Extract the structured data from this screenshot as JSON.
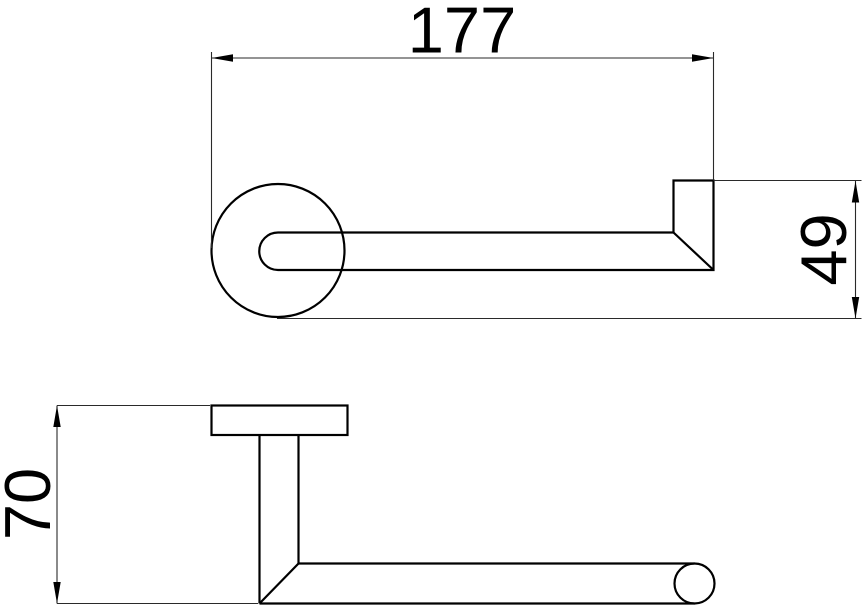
{
  "colors": {
    "background": "#ffffff",
    "object_line": "#000000",
    "dimension_line": "#2a2a2a",
    "text": "#000000"
  },
  "drawing": {
    "dimensions": {
      "width": "177",
      "height": "49",
      "depth": "70"
    }
  }
}
